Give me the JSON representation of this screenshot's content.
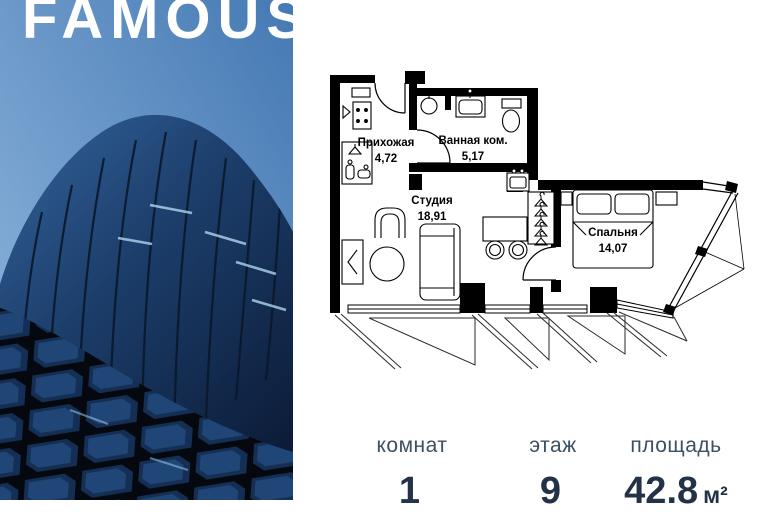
{
  "brand": {
    "logo": "FAMOUS"
  },
  "floor_plan": {
    "rooms": [
      {
        "name": "Прихожая",
        "area": "4,72"
      },
      {
        "name": "Ванная ком.",
        "area": "5,17"
      },
      {
        "name": "Студия",
        "area": "18,91"
      },
      {
        "name": "Спальня",
        "area": "14,07"
      }
    ]
  },
  "stats": [
    {
      "label": "комнат",
      "value": "1",
      "unit": ""
    },
    {
      "label": "этаж",
      "value": "9",
      "unit": ""
    },
    {
      "label": "площадь",
      "value": "42.8",
      "unit": "м²"
    }
  ],
  "colors": {
    "sky_top": "#4579b3",
    "sky_bottom": "#93b9e0",
    "glass_light": "#2f5d95",
    "glass_dark": "#0e2140",
    "stat_label": "#3d4f63",
    "stat_value": "#243247",
    "plan_line": "#000000"
  }
}
